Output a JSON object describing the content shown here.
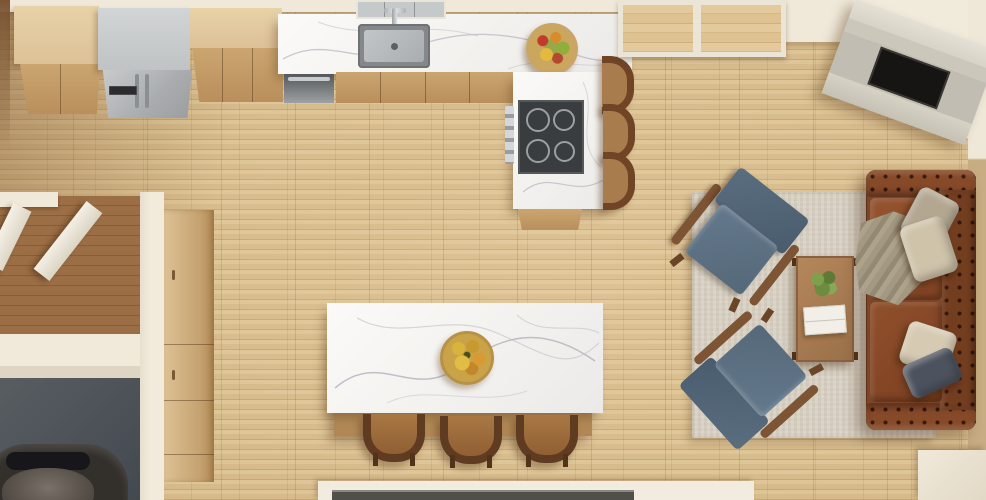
{
  "scene": {
    "type": "3d-render-top-view",
    "description": "Top-down architectural render of an open-plan kitchen and living room with light oak flooring, marble island, corner fireplace and leather sofa",
    "palette": {
      "floor_oak": "#d3b688",
      "floor_walnut": "#936540",
      "garage_floor": "#53585c",
      "wall_cream": "#f0e9da",
      "marble_white": "#f6f5f2",
      "marble_vein": "#b7b7c0",
      "cabinet_wood": "#c49a66",
      "cabinet_wood_light": "#e2c99e",
      "stainless_steel": "#b4b7b9",
      "cooktop_black": "#3a3d40",
      "sofa_leather": "#7e4426",
      "armchair_blue": "#576b7e",
      "rug_beige": "#d8d1c4",
      "coffee_table_wood": "#a87c52",
      "fireplace_stone": "#d8d3c7",
      "firebox_black": "#161514",
      "stool_wood": "#6f4526",
      "car_body": "#332f2b"
    },
    "items": [
      {
        "id": 0,
        "label": "Kitchen upper cabinets"
      },
      {
        "id": 1,
        "label": "Stainless steel refrigerator"
      },
      {
        "id": 2,
        "label": "Marble kitchen counter"
      },
      {
        "id": 3,
        "label": "Undermount sink with faucet"
      },
      {
        "id": 4,
        "label": "Black cooktop with four burners"
      },
      {
        "id": 5,
        "label": "Stainless dishwasher"
      },
      {
        "id": 6,
        "label": "Counter bar stools"
      },
      {
        "id": 7,
        "label": "Built-in wall console"
      },
      {
        "id": 8,
        "label": "Corner fireplace with black firebox"
      },
      {
        "id": 9,
        "label": "Beige area rug"
      },
      {
        "id": 10,
        "label": "Blue fabric armchair"
      },
      {
        "id": 11,
        "label": "Blue fabric armchair"
      },
      {
        "id": 12,
        "label": "Wood coffee table with plant and book"
      },
      {
        "id": 13,
        "label": "Brown leather chesterfield sofa with pillows and throw"
      },
      {
        "id": 14,
        "label": "Marble kitchen island"
      },
      {
        "id": 15,
        "label": "Island wooden stools"
      },
      {
        "id": 16,
        "label": "Bowl of fruit"
      },
      {
        "id": 17,
        "label": "Open white entry doors"
      },
      {
        "id": 18,
        "label": "Pantry cabinet column"
      },
      {
        "id": 19,
        "label": "Garage with parked car"
      },
      {
        "id": 20,
        "label": "Bottom window wall"
      }
    ]
  }
}
